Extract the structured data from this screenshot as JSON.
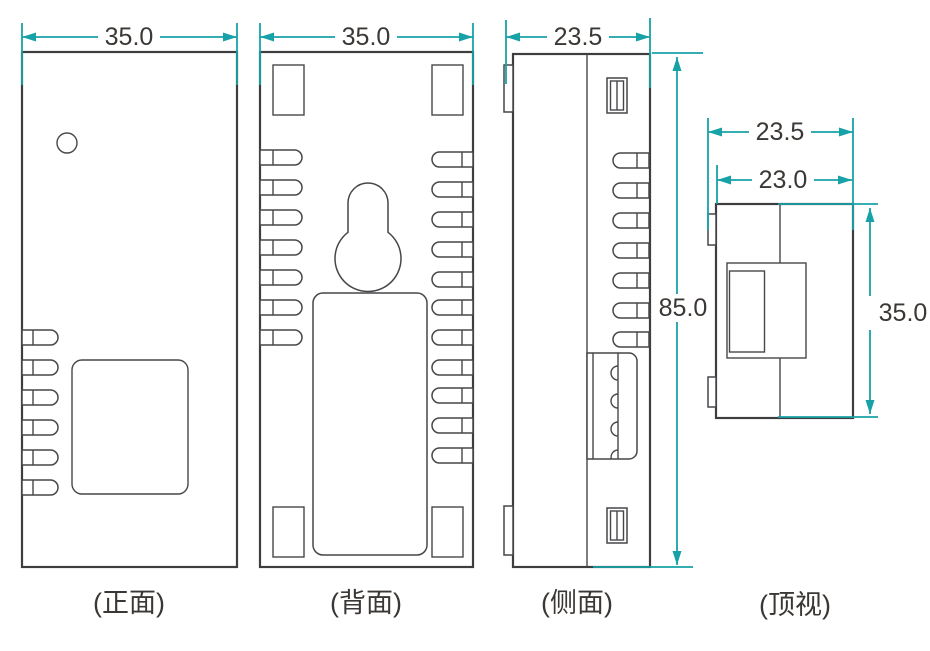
{
  "drawing": {
    "kind": "product-dimension-drawing",
    "colors": {
      "dimension_line": "#17a2a7",
      "outline": "#3e3e40",
      "text": "#3b3734"
    },
    "views": [
      {
        "id": "front",
        "label": "(正面)",
        "dims": [
          {
            "axis": "width",
            "value": "35.0"
          }
        ]
      },
      {
        "id": "back",
        "label": "(背面)",
        "dims": [
          {
            "axis": "width",
            "value": "35.0"
          }
        ]
      },
      {
        "id": "side",
        "label": "(侧面)",
        "dims": [
          {
            "axis": "depth",
            "value": "23.5"
          },
          {
            "axis": "height",
            "value": "85.0"
          }
        ]
      },
      {
        "id": "top",
        "label": "(顶视)",
        "dims": [
          {
            "axis": "depth-overall",
            "value": "23.5"
          },
          {
            "axis": "depth-body",
            "value": "23.0"
          },
          {
            "axis": "width",
            "value": "35.0"
          }
        ]
      }
    ]
  }
}
